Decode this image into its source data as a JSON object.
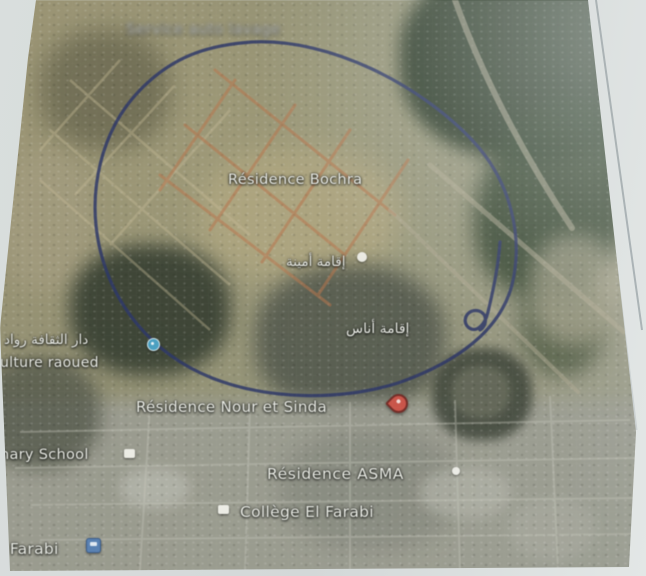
{
  "labels": {
    "illegible_top": {
      "text": "Service auto lavage"
    },
    "residence_bochra": {
      "text": "Résidence Bochra"
    },
    "iqama_amina": {
      "text": "إقامة أمينة"
    },
    "iqama_anas": {
      "text": "إقامة أناس"
    },
    "dar_thaqafa_raoued": {
      "text": "دار الثقافة رواد"
    },
    "culture_raoued": {
      "text": "ulture raoued"
    },
    "primary_school": {
      "text": "nary School"
    },
    "residence_nour_et_sinda": {
      "text": "Résidence Nour et Sinda"
    },
    "residence_asma": {
      "text": "Résidence ASMA"
    },
    "college_el_farabi": {
      "text": "Collège El Farabi"
    },
    "el_farabi": {
      "text": "l Farabi"
    }
  },
  "icons": [
    {
      "name": "culture-place-icon",
      "color": "#35a3cd"
    },
    {
      "name": "residence-amina-icon",
      "color": "#f4f4ee"
    },
    {
      "name": "red-marker-pin-icon",
      "color": "#df4b3c"
    },
    {
      "name": "school-icon",
      "color": "#f6f6ee"
    },
    {
      "name": "residence-asma-icon",
      "color": "#f4f4ee"
    },
    {
      "name": "college-icon",
      "color": "#f6f6ee"
    },
    {
      "name": "transit-blue-icon",
      "color": "#4c80bf"
    }
  ],
  "annotations": {
    "pen_circle_color": "#25316e",
    "highlighted_roads_color": "#c4703c"
  },
  "colors": {
    "paper": "#d3d8d8",
    "terrain_base": "#8f8c66",
    "forest": "#263a23",
    "urban_light": "#9b9d90"
  }
}
